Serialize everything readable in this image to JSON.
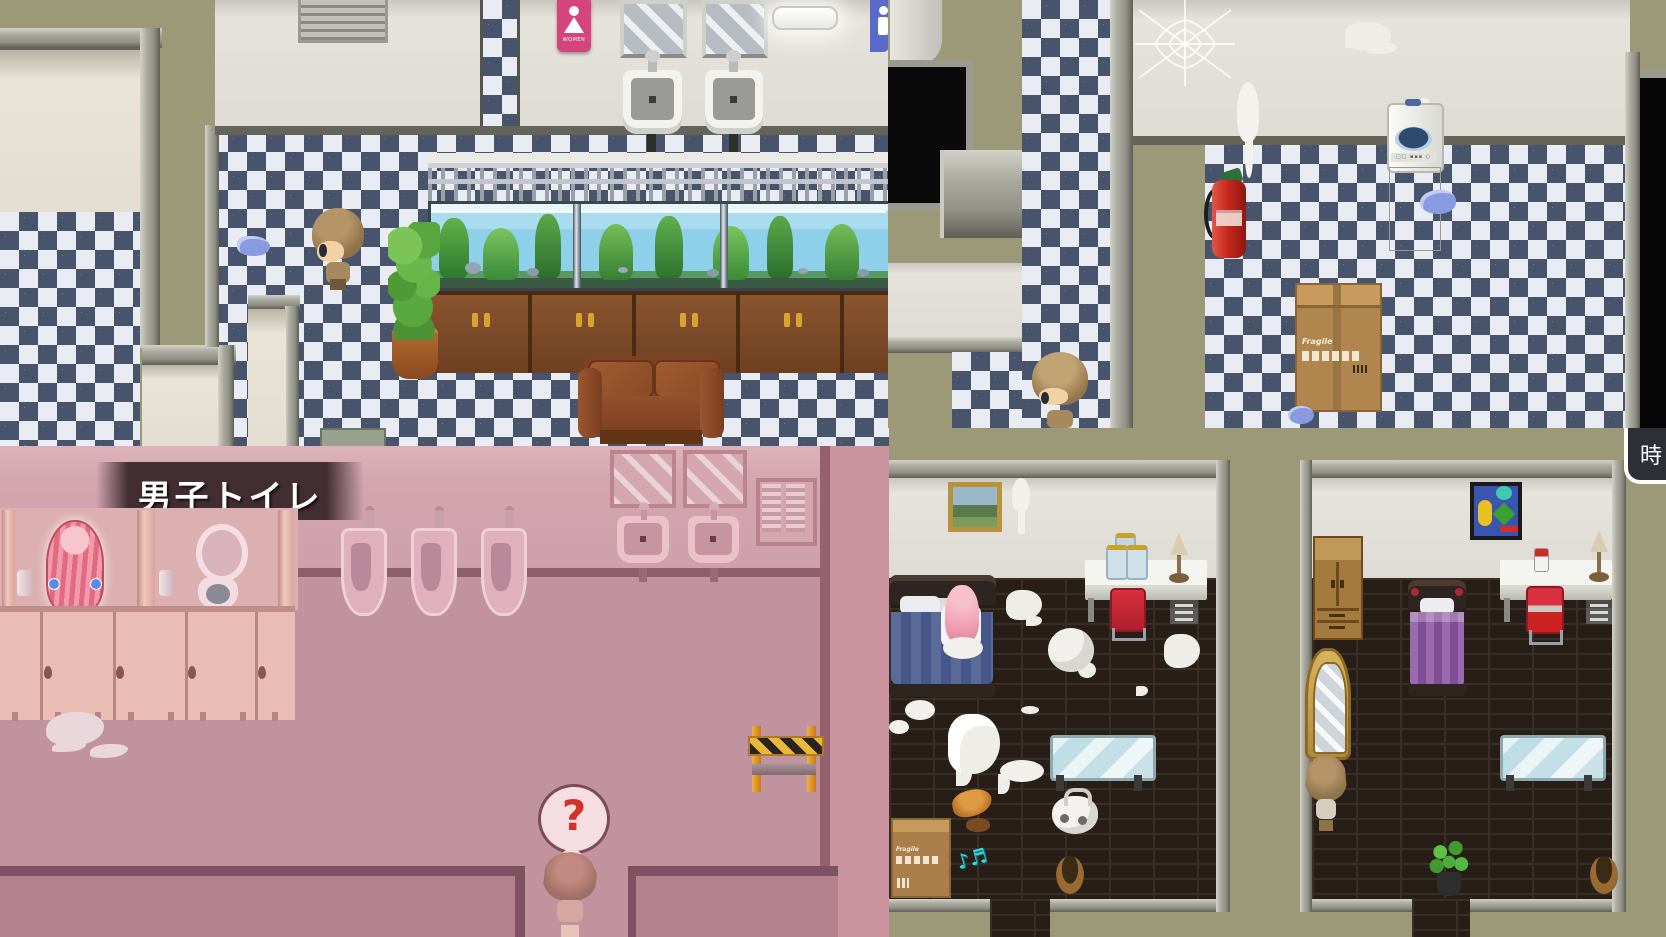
{
  "labels": {
    "mens_toilet": "男子トイレ",
    "time_tab": "時",
    "question_mark": "?",
    "women_sign": "WOMEN",
    "fragile": "Fragile"
  },
  "icons": {
    "women_sign_icon": "female-figure",
    "men_sign_icon": "male-figure",
    "question_bubble_icon": "question-mark",
    "time_tab_icon": "clock-kanji"
  },
  "colors": {
    "olive_wall": "#9c9979",
    "checker_navy": "#48546c",
    "checker_white": "#e9edf3",
    "pink_wall": "#d2a5af",
    "pink_floor": "#c0939f",
    "women_sign_pink": "#d6447e",
    "men_sign_blue": "#5a6ac8",
    "banner_dark": "#2e1d20",
    "bedroom_floor": "#261e17",
    "accent_chair_red": "#cc2433",
    "tab_background": "#2e2e36",
    "extinguisher_red": "#c8281e",
    "aquarium_water": "#9fd8ef"
  }
}
